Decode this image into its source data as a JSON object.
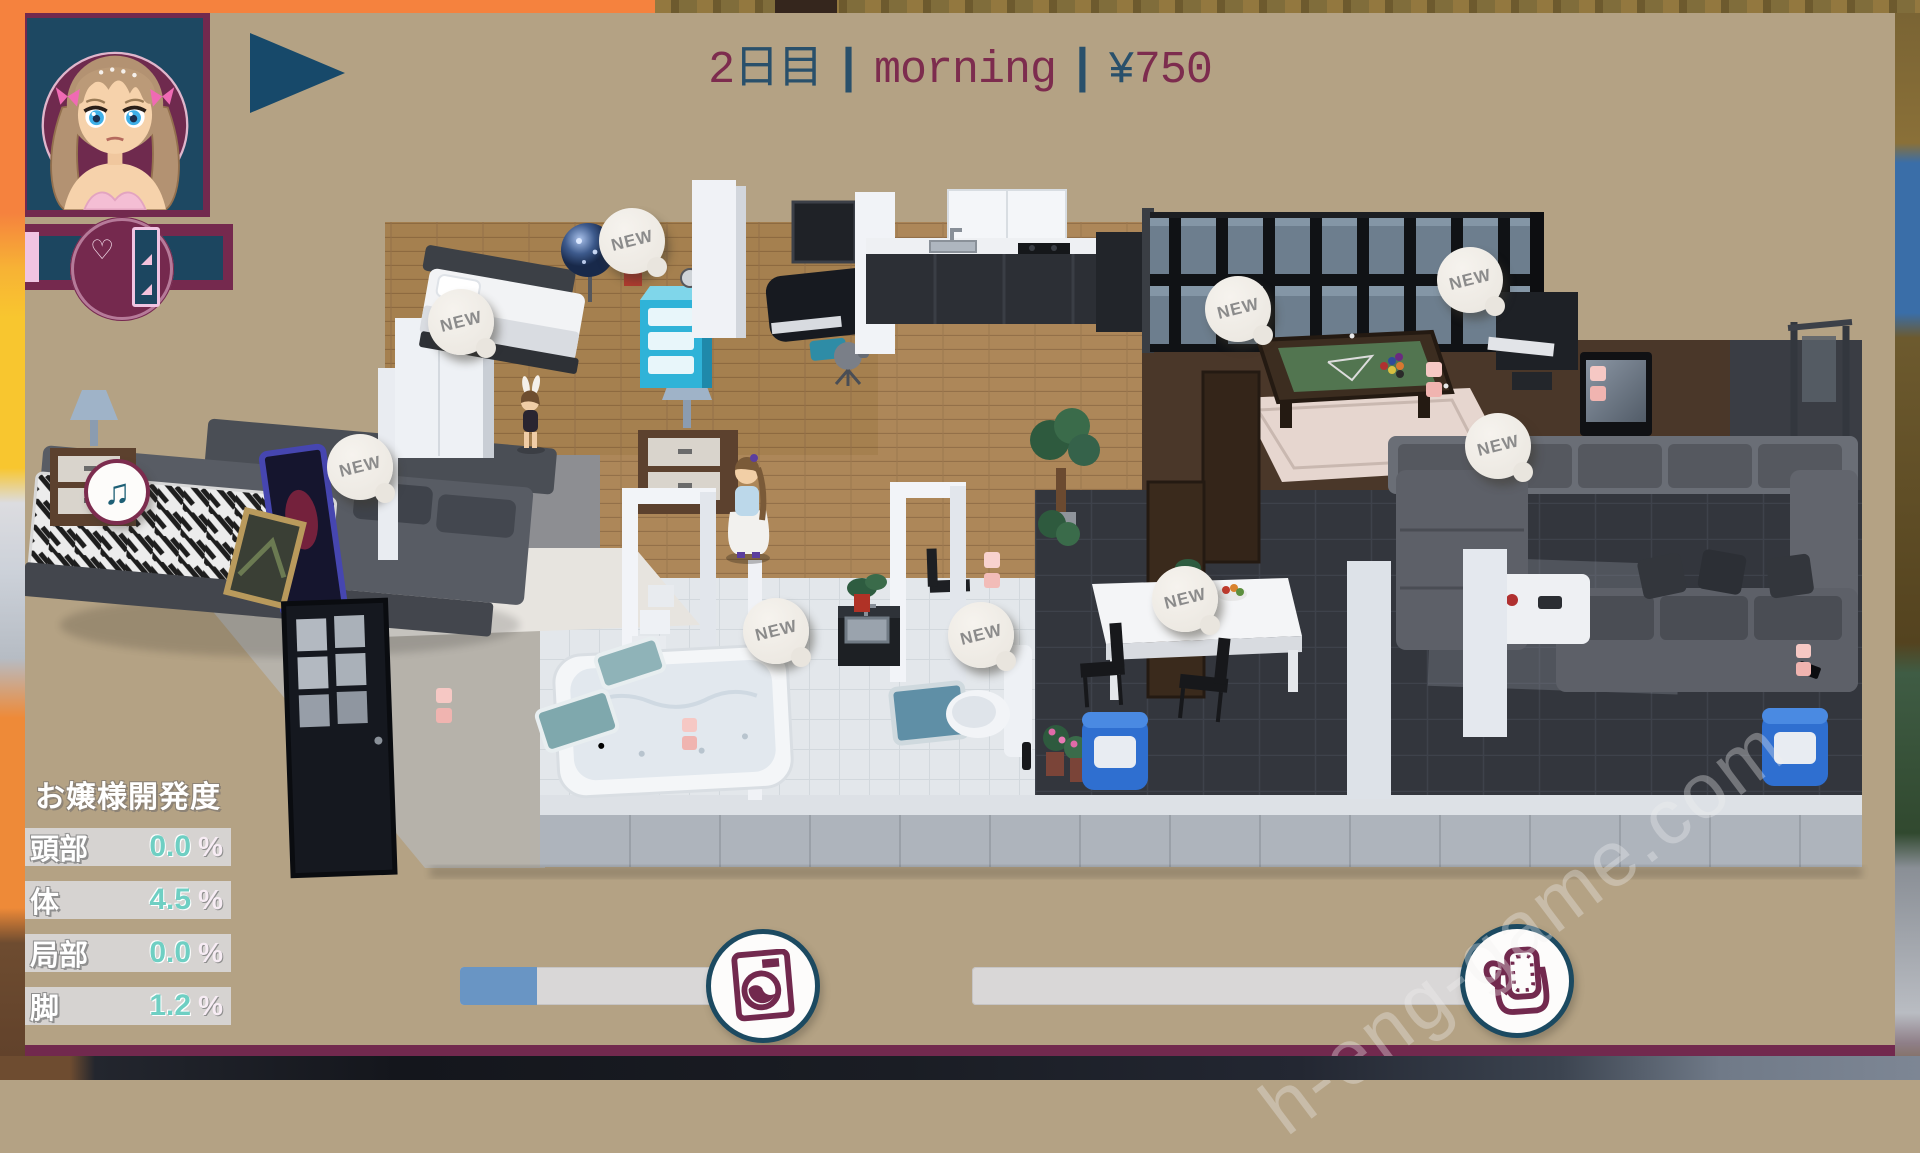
{
  "hud": {
    "day": {
      "number": "2",
      "suffix": "日目"
    },
    "separator": "|",
    "time_of_day": "morning",
    "currency": {
      "symbol": "¥",
      "amount": "750"
    },
    "portrait_name": "girl-portrait",
    "gauge": {
      "heart": "♡"
    }
  },
  "stats_panel": {
    "title": "お嬢様開発度",
    "rows": [
      {
        "label": "頭部",
        "value": "0.0",
        "unit": "%"
      },
      {
        "label": "体",
        "value": "4.5",
        "unit": "%"
      },
      {
        "label": "局部",
        "value": "0.0",
        "unit": "%"
      },
      {
        "label": "脚",
        "value": "1.2",
        "unit": "%"
      }
    ]
  },
  "progress": {
    "laundry": {
      "percent": 23,
      "icon": "washing-machine-icon"
    },
    "bag": {
      "percent": 0,
      "icon": "bag-icon"
    }
  },
  "scene": {
    "new_label": "NEW",
    "new_badges": [
      {
        "x": 632,
        "y": 241
      },
      {
        "x": 461,
        "y": 322
      },
      {
        "x": 1238,
        "y": 309
      },
      {
        "x": 1470,
        "y": 280
      },
      {
        "x": 360,
        "y": 467
      },
      {
        "x": 1498,
        "y": 446
      },
      {
        "x": 776,
        "y": 631
      },
      {
        "x": 981,
        "y": 635
      },
      {
        "x": 1185,
        "y": 599
      }
    ],
    "music_badge": {
      "x": 117,
      "y": 492,
      "glyph": "♫"
    }
  },
  "watermark": "h-eng-game.com",
  "colors": {
    "maroon": "#72294e",
    "navy": "#17496a",
    "tan": "#b4a284",
    "stat_value_teal": "#6fcfc3",
    "bar_fill_blue": "#6995c4",
    "badge_bg": "#efece6"
  }
}
